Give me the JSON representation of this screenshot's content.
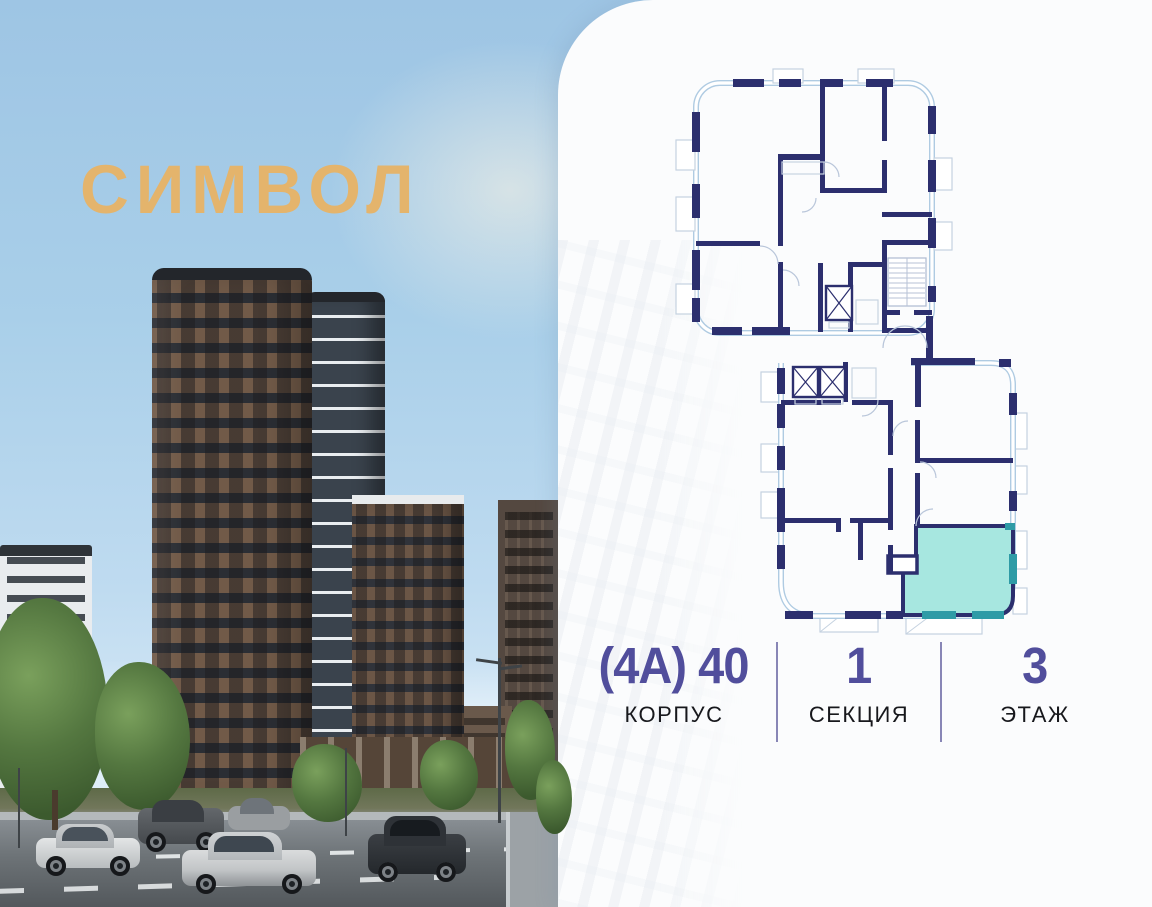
{
  "branding": {
    "logo_text": "СИМВОЛ"
  },
  "info_bar": {
    "columns": [
      {
        "value": "(4А) 40",
        "label": "КОРПУС"
      },
      {
        "value": "1",
        "label": "СЕКЦИЯ"
      },
      {
        "value": "3",
        "label": "ЭТАЖ"
      }
    ]
  },
  "floor_plan": {
    "description": "section floor plan with one highlighted apartment, lower right",
    "highlighted_unit": {
      "building": "(4А) 40",
      "section": "1",
      "floor": "3"
    }
  },
  "colors": {
    "logo": "#E4B46C",
    "info_value": "#514E9C",
    "divider": "#8886B6",
    "wall": "#2C2F6E",
    "boundary": "#AFCBE2",
    "highlight_fill": "#A7E7E0",
    "highlight_window": "#2E9BA6"
  }
}
